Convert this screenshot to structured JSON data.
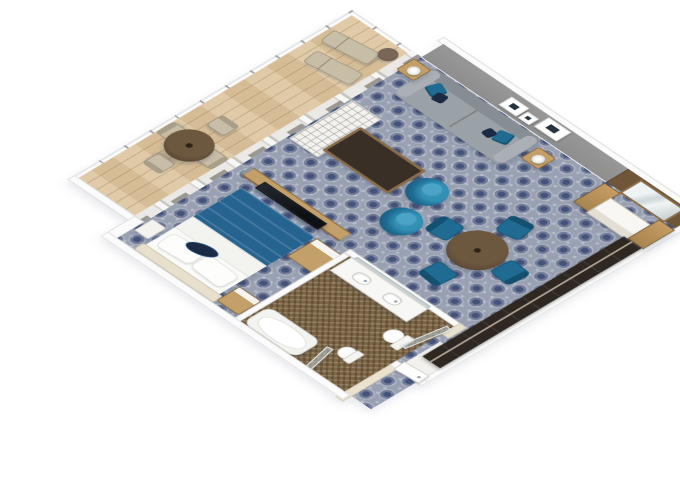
{
  "scene": {
    "type": "3d-floorplan-render",
    "description": "Isometric cutaway 3D rendering of a ship suite stateroom with balcony, living room, bedroom, bathroom and entry corridor",
    "visible_text": [],
    "rooms": [
      {
        "name": "balcony",
        "floor": "light-wood-planks",
        "features": [
          "white-railing",
          "divider-wall",
          "sliding-glass-doors"
        ],
        "furniture": [
          "round-dining-table",
          "dining-chair",
          "dining-chair",
          "dining-chair",
          "dining-chair",
          "sun-lounger",
          "sun-lounger",
          "round-side-table"
        ]
      },
      {
        "name": "living-room",
        "floor": "blue-medallion-carpet",
        "features": [
          "gray-accent-wall",
          "picture-frames-x3",
          "curtained-window-wall"
        ],
        "furniture": [
          "sofa-with-teal-pillows",
          "side-table-with-lamp",
          "side-table-with-lamp",
          "white-lattice-bench",
          "dark-wood-coffee-table",
          "teal-barrel-chair",
          "teal-barrel-chair",
          "round-dining-table",
          "teal-dining-chair-x4"
        ]
      },
      {
        "name": "bedroom",
        "floor": "blue-medallion-carpet",
        "furniture": [
          "double-bed-blue-duvet",
          "navy-accent-pillow",
          "tv-partition-with-tv",
          "nightstand",
          "white-stool",
          "dresser"
        ]
      },
      {
        "name": "bathroom",
        "floor": "brown-mosaic-tile",
        "furniture": [
          "double-sink-vanity",
          "vanity-mirror",
          "bathtub",
          "toilet",
          "bidet",
          "glass-partition",
          "glass-partition"
        ]
      },
      {
        "name": "entry",
        "floor": "carpet-and-white-vestibule",
        "furniture": [
          "dark-wardrobe-closet",
          "entry-door"
        ]
      },
      {
        "name": "console-area",
        "furniture": [
          "media-console-with-mirror",
          "wood-cabinet-column",
          "wood-cabinet-column"
        ]
      }
    ],
    "counts": {
      "picture_frames": 3,
      "teal_dining_chairs": 4,
      "balcony_chairs": 4,
      "barrel_chairs": 2,
      "loungers": 2,
      "sinks": 2
    },
    "palette": {
      "canvas-bg": "#ffffff",
      "carpet-base": "#98a0b2",
      "carpet-dark": "#45527a",
      "wood-floor": "#dcc49e",
      "bath-floor": "#7c6546",
      "bath-cream": "#eae2cf",
      "wall-white": "#fbfbfb",
      "wall-edge": "#dcdcda",
      "wall-gray": "#8e8e8e",
      "wall-wood": "#6f5638",
      "curtain": "#9b9891",
      "sofa": "#9ba2a7",
      "sofa-dark": "#878e93",
      "teal": "#1f6b92",
      "teal-light": "#3390b5",
      "navy": "#1b2a45",
      "duvet": "#27638f",
      "wood-furn": "#c3a06a",
      "table-dark": "#5c4936",
      "espresso": "#3a2f26",
      "closet": "#2f2721",
      "lounger": "#c8bda6"
    }
  }
}
